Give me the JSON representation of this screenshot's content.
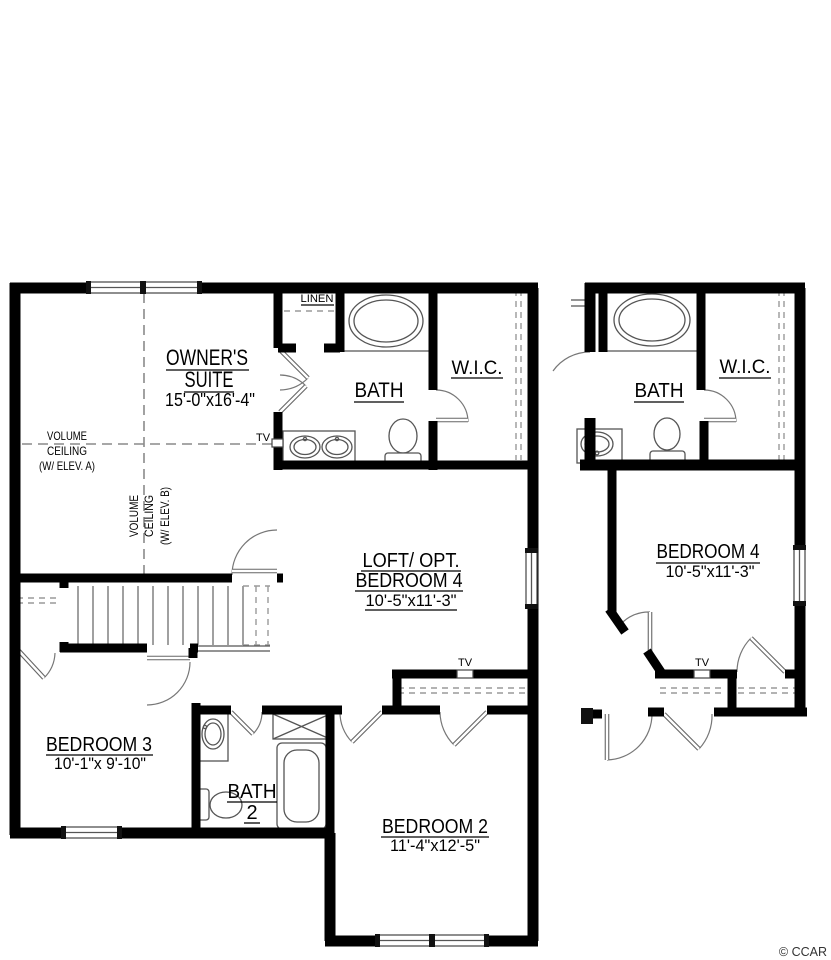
{
  "colors": {
    "wall": "#000000",
    "fixture_line": "#555555",
    "dash_line": "#8a8a8a",
    "background": "#ffffff"
  },
  "watermark": {
    "credit": "© CCAR"
  },
  "left_plan": {
    "owners_suite": {
      "name_line1": "OWNER'S",
      "name_line2": "SUITE",
      "dims": "15'-0\"x16'-4\"",
      "volume_ceiling_a": {
        "l1": "VOLUME",
        "l2": "CEILING",
        "l3": "(W/ ELEV. A)"
      },
      "volume_ceiling_b": {
        "l1": "VOLUME",
        "l2": "CEILING",
        "l3": "(W/ ELEV. B)"
      },
      "tv": "TV"
    },
    "linen": {
      "label": "LINEN"
    },
    "bath": {
      "label": "BATH"
    },
    "wic": {
      "label": "W.I.C."
    },
    "loft": {
      "name_line1": "LOFT/ OPT.",
      "name_line2": "BEDROOM 4",
      "dims": "10'-5\"x11'-3\""
    },
    "bedroom3": {
      "name": "BEDROOM 3",
      "dims": "10'-1\"x 9'-10\""
    },
    "bath2": {
      "name_line1": "BATH",
      "name_line2": "2"
    },
    "bedroom2": {
      "name": "BEDROOM 2",
      "dims": "11'-4\"x12'-5\"",
      "tv": "TV"
    }
  },
  "right_plan": {
    "bath": {
      "label": "BATH"
    },
    "wic": {
      "label": "W.I.C."
    },
    "bedroom4": {
      "name": "BEDROOM 4",
      "dims": "10'-5\"x11'-3\"",
      "tv": "TV"
    }
  }
}
